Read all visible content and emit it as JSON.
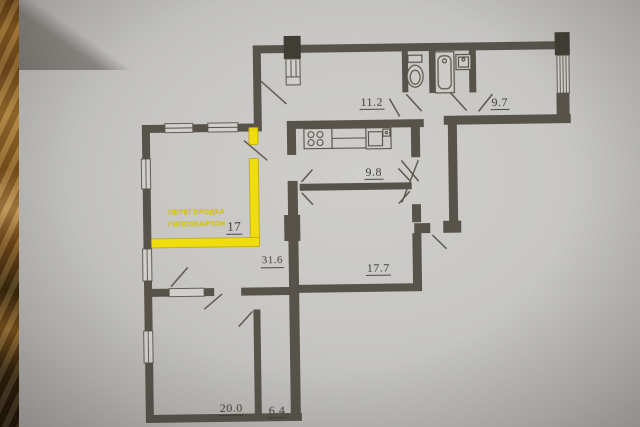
{
  "photo": {
    "description_table_color": "#96621f",
    "paper_color": "#c7c6c3"
  },
  "plan": {
    "wall_color": "#57534a",
    "pillar_color": "#403d35",
    "window_fill": "#d0cfcc",
    "fixture_fill": "#cdccc9",
    "rooms": [
      {
        "name": "hallway",
        "area": "11.2"
      },
      {
        "name": "room-top-right",
        "area": "9.7"
      },
      {
        "name": "kitchen",
        "area": "9.8"
      },
      {
        "name": "central-hall",
        "area": "31.6"
      },
      {
        "name": "room-middle",
        "area": "17.7"
      },
      {
        "name": "new-partition-room",
        "area": "17"
      },
      {
        "name": "room-bottom-left",
        "area": "20.0"
      },
      {
        "name": "room-bottom-small",
        "area": "6.4"
      }
    ],
    "annotation": {
      "line1": "ПЕРЕГОРОДКА",
      "line2": "ГИПСОКАРТОН",
      "highlight_color": "#f2df05",
      "edge_color": "#bfa500",
      "text_color": "#d9c70a"
    }
  }
}
